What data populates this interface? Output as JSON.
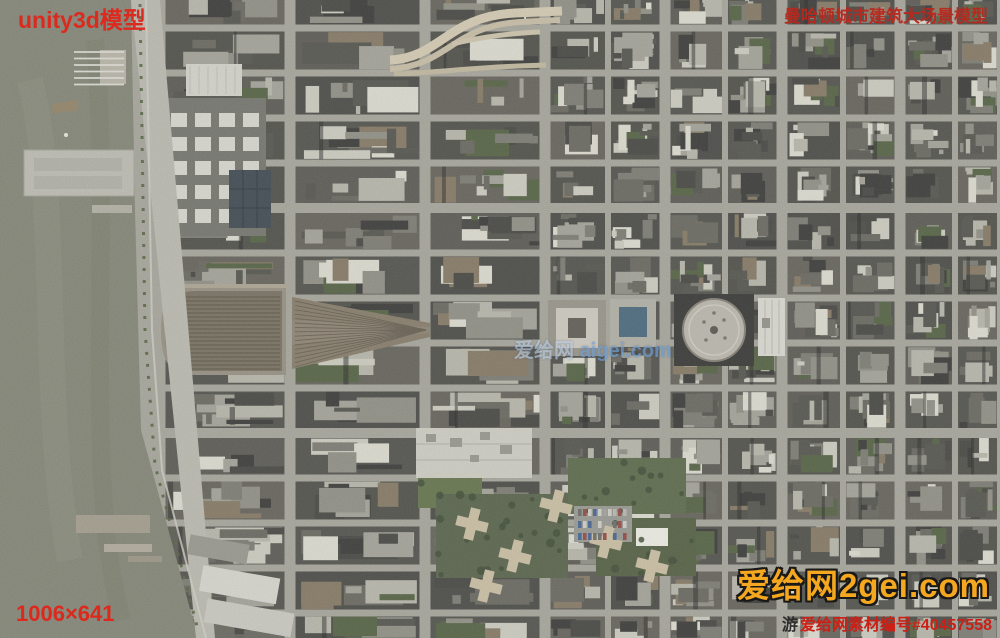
{
  "overlays": {
    "top_left_label": "unity3d模型",
    "top_right_title": "曼哈顿城市建筑大场景模型",
    "center_watermark": {
      "cn": "爱给网 ",
      "en": "aigei.com"
    },
    "dimensions_label": "1006×641",
    "brand_watermark": "爱给网2gei.com",
    "asset_id_prefix": "游",
    "asset_id_label": "爱给网素材编号#40457558"
  },
  "colors": {
    "overlay_red": "#dc2a1e",
    "brand_orange": "#f4a71f",
    "water": "#797c6c",
    "street": "#9d9d93",
    "rail_yard": "#7d7260"
  }
}
